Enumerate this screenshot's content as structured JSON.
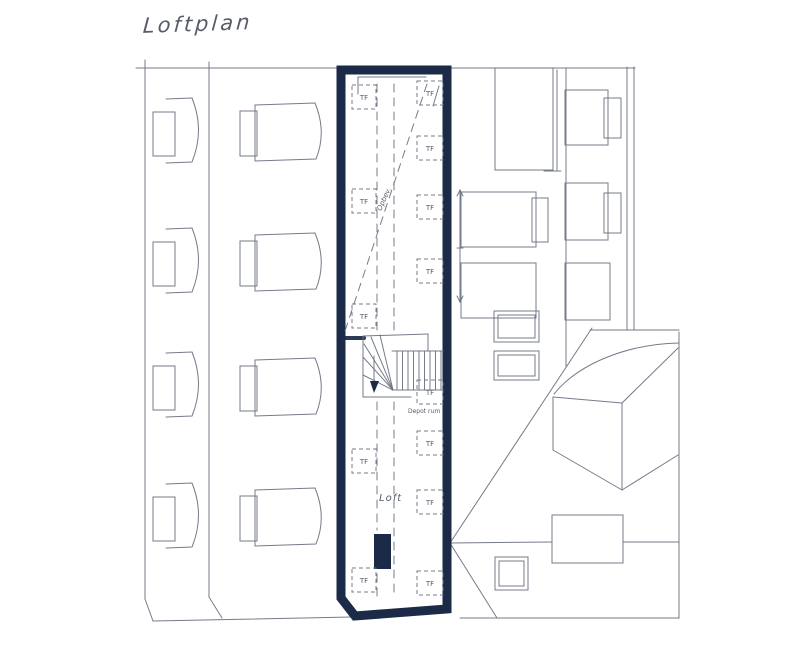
{
  "title": "Loftplan",
  "colors": {
    "paper": "#ffffff",
    "ink": "#6a7080",
    "wall_fill": "#1b2a47",
    "text": "#565c68"
  },
  "labels": {
    "skylight": "TF",
    "loft_room": "Loft",
    "storage_note": "Opbev.",
    "existing_note": "Depot rum"
  },
  "plan": {
    "skylights_left_y": [
      97,
      201,
      316,
      461,
      580
    ],
    "skylights_right_y": [
      93,
      148,
      207,
      271,
      392,
      443,
      502,
      583
    ],
    "dormer_rows_col1_y": [
      98,
      228,
      352,
      483
    ],
    "dormer_rows_col2_y": [
      103,
      233,
      358,
      488
    ]
  }
}
